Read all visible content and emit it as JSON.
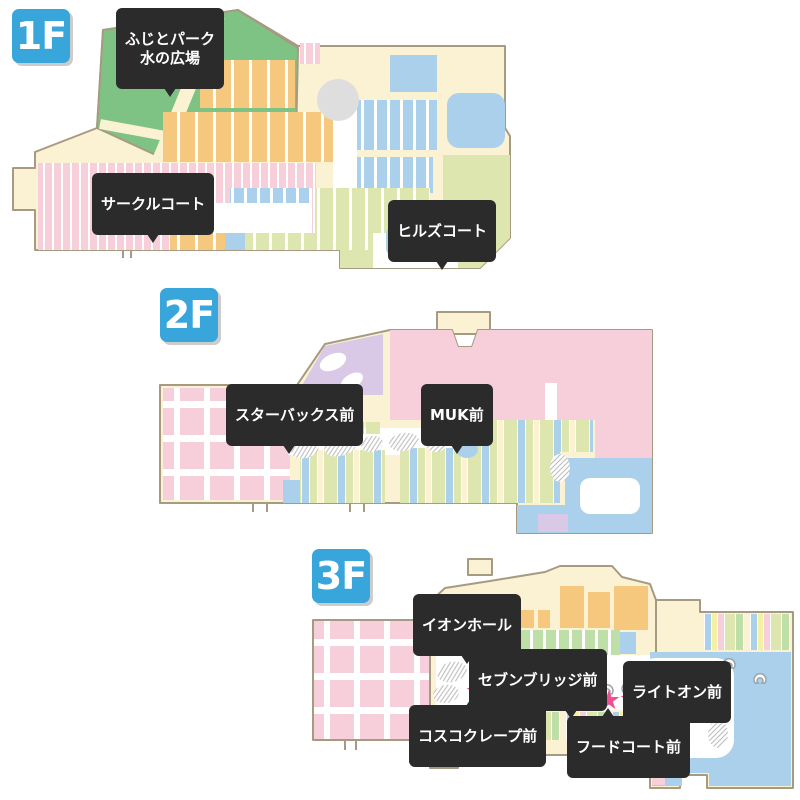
{
  "title": "ショッピングモール フロアマップ",
  "icons": {
    "star": "★"
  },
  "colors": {
    "star": "#F0508F",
    "badge": "#38A5DB",
    "label_bg": "#2B2B2B",
    "label_text": "#FFFFFF",
    "outline": "#A79A82",
    "cream": "#FBF1D3",
    "orange": "#F5C87E",
    "blue": "#ABD0EB",
    "green": "#DDE6AE",
    "park": "#7EC383",
    "pink": "#F6CFDB",
    "purple": "#D9C8E6",
    "mint": "#BFDFA9",
    "gray": "#DEDEDE",
    "yellow": "#F6F0A3"
  },
  "floors": [
    {
      "badge": "1F",
      "markers": [
        {
          "label": "ふじとパーク\n水の広場"
        },
        {
          "label": "サークルコート"
        },
        {
          "label": "ヒルズコート"
        }
      ]
    },
    {
      "badge": "2F",
      "markers": [
        {
          "label": "スターバックス前"
        },
        {
          "label": "MUK前"
        }
      ]
    },
    {
      "badge": "3F",
      "markers": [
        {
          "label": "イオンホール"
        },
        {
          "label": "セブンブリッジ前"
        },
        {
          "label": "ライトオン前"
        },
        {
          "label": "コスコクレープ前"
        },
        {
          "label": "フードコート前"
        }
      ]
    }
  ]
}
